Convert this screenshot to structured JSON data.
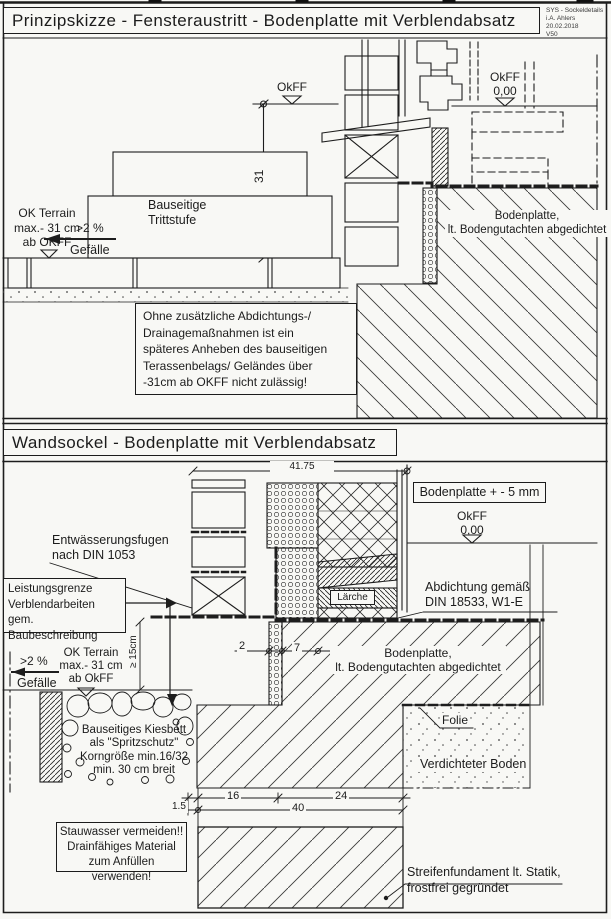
{
  "sheet": {
    "stamp": "SYS - Sockeldetails\ni.A. Ahlers 20.02.2018\nV50"
  },
  "top": {
    "title": "Prinzipskizze - Fensteraustritt - Bodenplatte mit Verblendabsatz",
    "okff_left": "OkFF",
    "okff_right": "OkFF\n0,00",
    "dim_31": "31",
    "step": "Bauseitige\nTrittstufe",
    "terrain": "OK Terrain\nmax.- 31 cm\nab OKFF",
    "slope": ">2 %",
    "slope_word": "Gefälle",
    "slab": "Bodenplatte,\nlt. Bodengutachten abgedichtet",
    "note": "Ohne zusätzliche Abdichtungs-/\nDrainagemaßnahmen ist ein\nspäteres Anheben des bauseitigen\nTerassenbelags/ Geländes über\n-31cm ab OKFF nicht zulässig!"
  },
  "bottom": {
    "title": "Wandsockel - Bodenplatte mit Verblendabsatz",
    "dim_4175": "41.75",
    "slab_tolerance": "Bodenplatte + - 5 mm",
    "okff": "OkFF\n0,00",
    "drain_joints": "Entwässerungsfugen\nnach DIN 1053",
    "scope": "Leistungsgrenze\nVerblendarbeiten\ngem. Baubeschreibung",
    "dim_15": "≥ 15cm",
    "slope": ">2 %",
    "slope_word": "Gefälle",
    "terrain": "OK Terrain\nmax.- 31 cm\nab OkFF",
    "sealing": "Abdichtung gemäß\nDIN 18533, W1-E",
    "larch": "Lärche",
    "dim_2": "2",
    "dim_7": "7",
    "slab": "Bodenplatte,\nlt. Bodengutachten abgedichtet",
    "gravel": "Bauseitiges Kiesbett\nals \"Spritzschutz\"\nKorngröße min.16/32\nmin. 30 cm breit",
    "foil": "Folie",
    "soil": "Verdichteter Boden",
    "dim_16": "16",
    "dim_24": "24",
    "dim_40": "40",
    "dim_1_5": "1.5",
    "water_note": "Stauwasser vermeiden!!\nDrainfähiges Material\nzum Anfüllen verwenden!",
    "foundation": "Streifenfundament lt. Statik,\nfrostfrei gegründet"
  }
}
